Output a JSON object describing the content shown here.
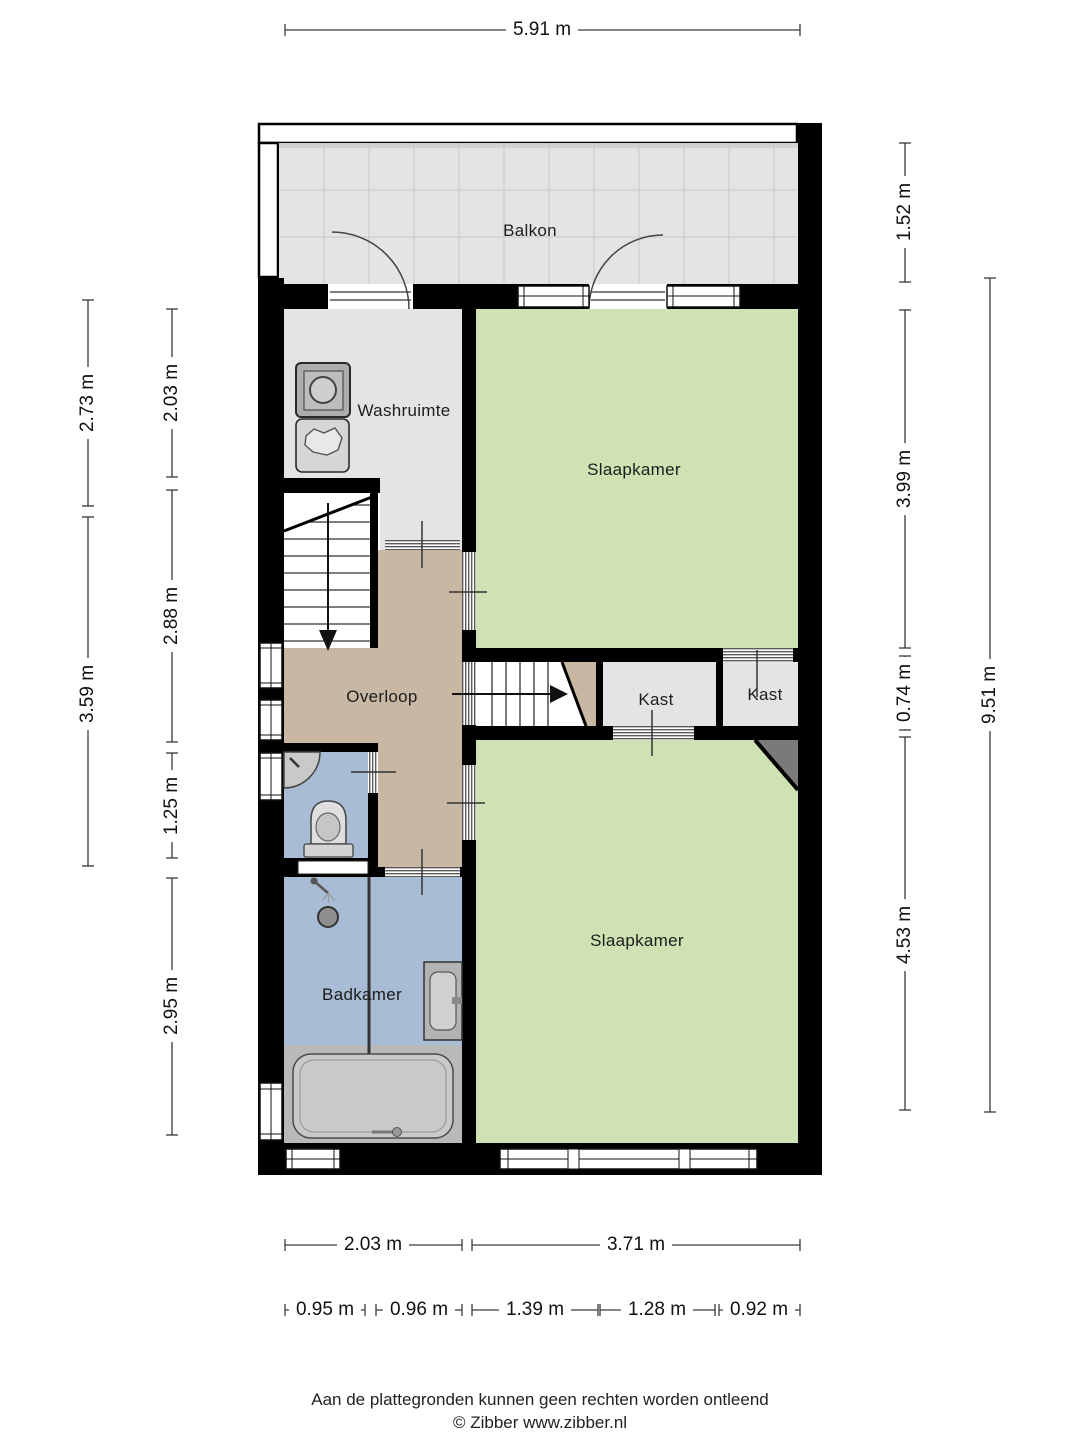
{
  "rooms": {
    "balkon": "Balkon",
    "washruimte": "Washruimte",
    "slaapkamer_top": "Slaapkamer",
    "slaapkamer_bottom": "Slaapkamer",
    "overloop": "Overloop",
    "kast_left": "Kast",
    "kast_right": "Kast",
    "badkamer": "Badkamer"
  },
  "dimensions": {
    "top_width": "5.91 m",
    "left_outer": [
      "2.73 m",
      "3.59 m"
    ],
    "left_inner": [
      "2.03 m",
      "2.88 m",
      "1.25 m",
      "2.95 m"
    ],
    "right_inner": [
      "1.52 m",
      "3.99 m",
      "0.74 m",
      "4.53 m"
    ],
    "right_outer": "9.51 m",
    "bottom_row1": [
      "2.03 m",
      "3.71 m"
    ],
    "bottom_row2": [
      "0.95 m",
      "0.96 m",
      "1.39 m",
      "1.28 m",
      "0.92 m"
    ]
  },
  "footer": {
    "disclaimer": "Aan de plattegronden kunnen geen rechten worden ontleend",
    "copyright": "© Zibber www.zibber.nl"
  },
  "colors": {
    "wall": "#000000",
    "floor_green": "#cfe2b3",
    "floor_tan": "#c8b7a3",
    "floor_blue": "#a8bcd5",
    "floor_gray": "#e4e4e4",
    "floor_bath_zone": "#b9b9b9",
    "diagonal_gray": "#7a7a7a",
    "balcony_grid": "#c9c9c9",
    "dim_line": "#3a3a3a",
    "text": "#1c1c1c"
  },
  "icons": {
    "washing_machine": "washing-machine-icon",
    "laundry_basket": "laundry-basket-icon",
    "toilet": "toilet-icon",
    "corner_washbasin": "corner-washbasin-icon",
    "shower_head": "shower-head-icon",
    "shower_drain": "shower-drain-icon",
    "washbasin": "washbasin-icon",
    "bathtub": "bathtub-icon",
    "stairs_down_arrow": "stairs-down-arrow-icon",
    "stairs_up_arrow": "stairs-up-arrow-icon"
  }
}
